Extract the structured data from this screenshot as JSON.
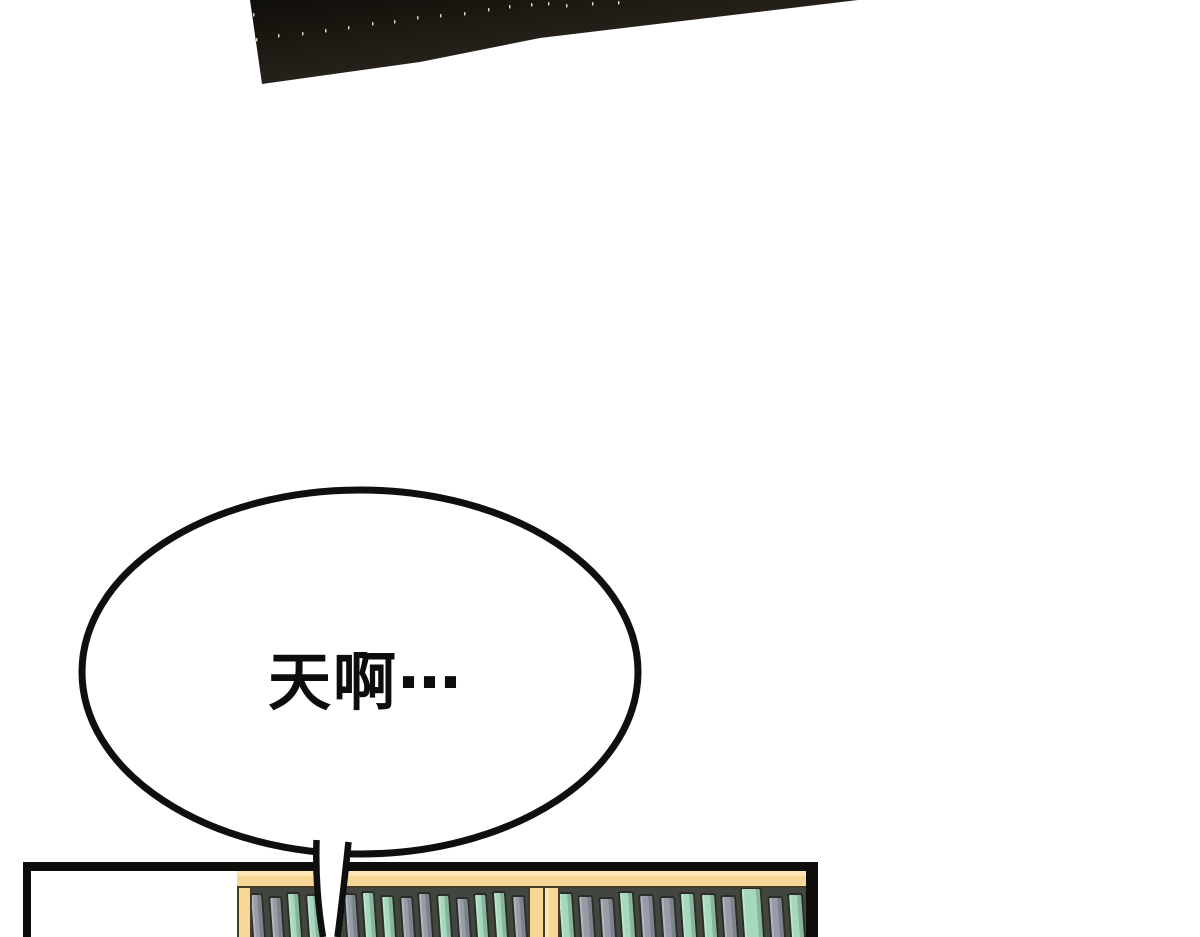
{
  "bubble": {
    "text": "天啊⋯"
  },
  "colors": {
    "ink": "#0e0d0b",
    "dark_start": "#100e09",
    "dark_end": "#3b342b",
    "speck": "#ece6d8",
    "tan": "#f6d795",
    "tan_light": "#fce7b4",
    "frame_line": "#453b28",
    "shelf_dark": "#41463f",
    "teal": "#a5d8bc",
    "gray": "#969da7"
  },
  "dark_panel": {
    "shape_points": "250,0 858,0 540,38 420,62 262,84",
    "specks": [
      [
        253,
        13
      ],
      [
        256,
        38
      ],
      [
        278,
        34
      ],
      [
        302,
        32
      ],
      [
        325,
        29
      ],
      [
        348,
        26
      ],
      [
        372,
        22
      ],
      [
        394,
        20
      ],
      [
        417,
        16
      ],
      [
        440,
        14
      ],
      [
        464,
        12
      ],
      [
        488,
        8
      ],
      [
        509,
        5
      ],
      [
        531,
        3
      ],
      [
        548,
        2
      ],
      [
        566,
        4
      ],
      [
        592,
        2
      ],
      [
        618,
        1
      ]
    ]
  },
  "bookshelf": {
    "left_books": [
      {
        "c": "gray",
        "w": 14,
        "h": 44
      },
      {
        "c": "gray",
        "w": 14,
        "h": 41
      },
      {
        "c": "teal",
        "w": 14,
        "h": 45
      },
      {
        "c": "teal",
        "w": 14,
        "h": 43
      },
      {
        "c": "gray",
        "w": 14,
        "h": 40
      },
      {
        "c": "gray",
        "w": 14,
        "h": 44
      },
      {
        "c": "teal",
        "w": 14,
        "h": 46
      },
      {
        "c": "teal",
        "w": 14,
        "h": 42
      },
      {
        "c": "gray",
        "w": 14,
        "h": 41
      },
      {
        "c": "gray",
        "w": 14,
        "h": 45
      },
      {
        "c": "teal",
        "w": 14,
        "h": 43
      },
      {
        "c": "gray",
        "w": 14,
        "h": 40
      },
      {
        "c": "teal",
        "w": 14,
        "h": 44
      },
      {
        "c": "teal",
        "w": 14,
        "h": 46
      },
      {
        "c": "gray",
        "w": 14,
        "h": 42
      }
    ],
    "right_books": [
      {
        "c": "teal",
        "w": 16,
        "h": 45
      },
      {
        "c": "gray",
        "w": 16,
        "h": 42
      },
      {
        "c": "gray",
        "w": 16,
        "h": 40
      },
      {
        "c": "teal",
        "w": 16,
        "h": 46
      },
      {
        "c": "gray",
        "w": 16,
        "h": 43
      },
      {
        "c": "gray",
        "w": 16,
        "h": 41
      },
      {
        "c": "teal",
        "w": 16,
        "h": 45
      },
      {
        "c": "teal",
        "w": 16,
        "h": 44
      },
      {
        "c": "gray",
        "w": 16,
        "h": 42
      },
      {
        "c": "teal",
        "w": 22,
        "h": 50
      },
      {
        "c": "gray",
        "w": 16,
        "h": 41
      },
      {
        "c": "teal",
        "w": 16,
        "h": 44
      }
    ]
  }
}
